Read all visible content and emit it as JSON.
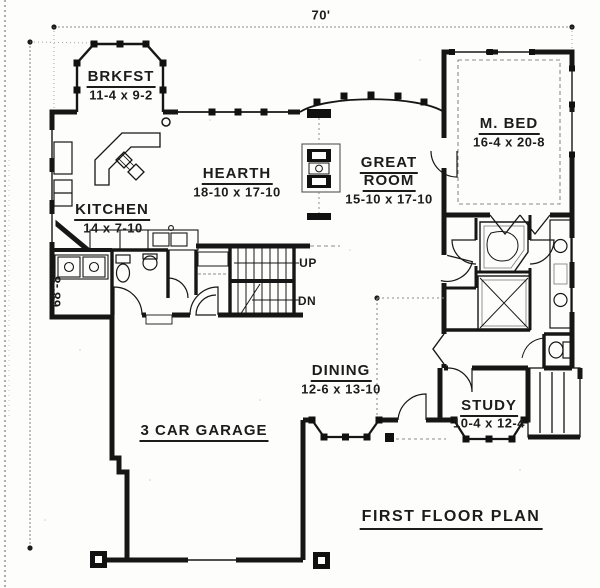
{
  "plan_title": "FIRST FLOOR PLAN",
  "dimension_labels": {
    "width": "70'",
    "height": "68'-8\""
  },
  "rooms": {
    "brkfst": {
      "name": "BRKFST",
      "dims": "11-4 x 9-2"
    },
    "hearth": {
      "name": "HEARTH",
      "dims": "18-10 x 17-10"
    },
    "kitchen": {
      "name": "KITCHEN",
      "dims": "14 x 7-10"
    },
    "great_room": {
      "name": "GREAT",
      "name2": "ROOM",
      "dims": "15-10 x 17-10"
    },
    "m_bed": {
      "name": "M. BED",
      "dims": "16-4 x 20-8"
    },
    "dining": {
      "name": "DINING",
      "dims": "12-6 x 13-10"
    },
    "study": {
      "name": "STUDY",
      "dims": "10-4 x 12-4"
    },
    "garage": {
      "name": "3 CAR GARAGE"
    }
  },
  "stairs": {
    "up": "UP",
    "dn": "DN"
  },
  "colors": {
    "ink": "#1c1c1c",
    "paper": "#fdfdfb",
    "dim_gray": "#8a8a8a"
  }
}
